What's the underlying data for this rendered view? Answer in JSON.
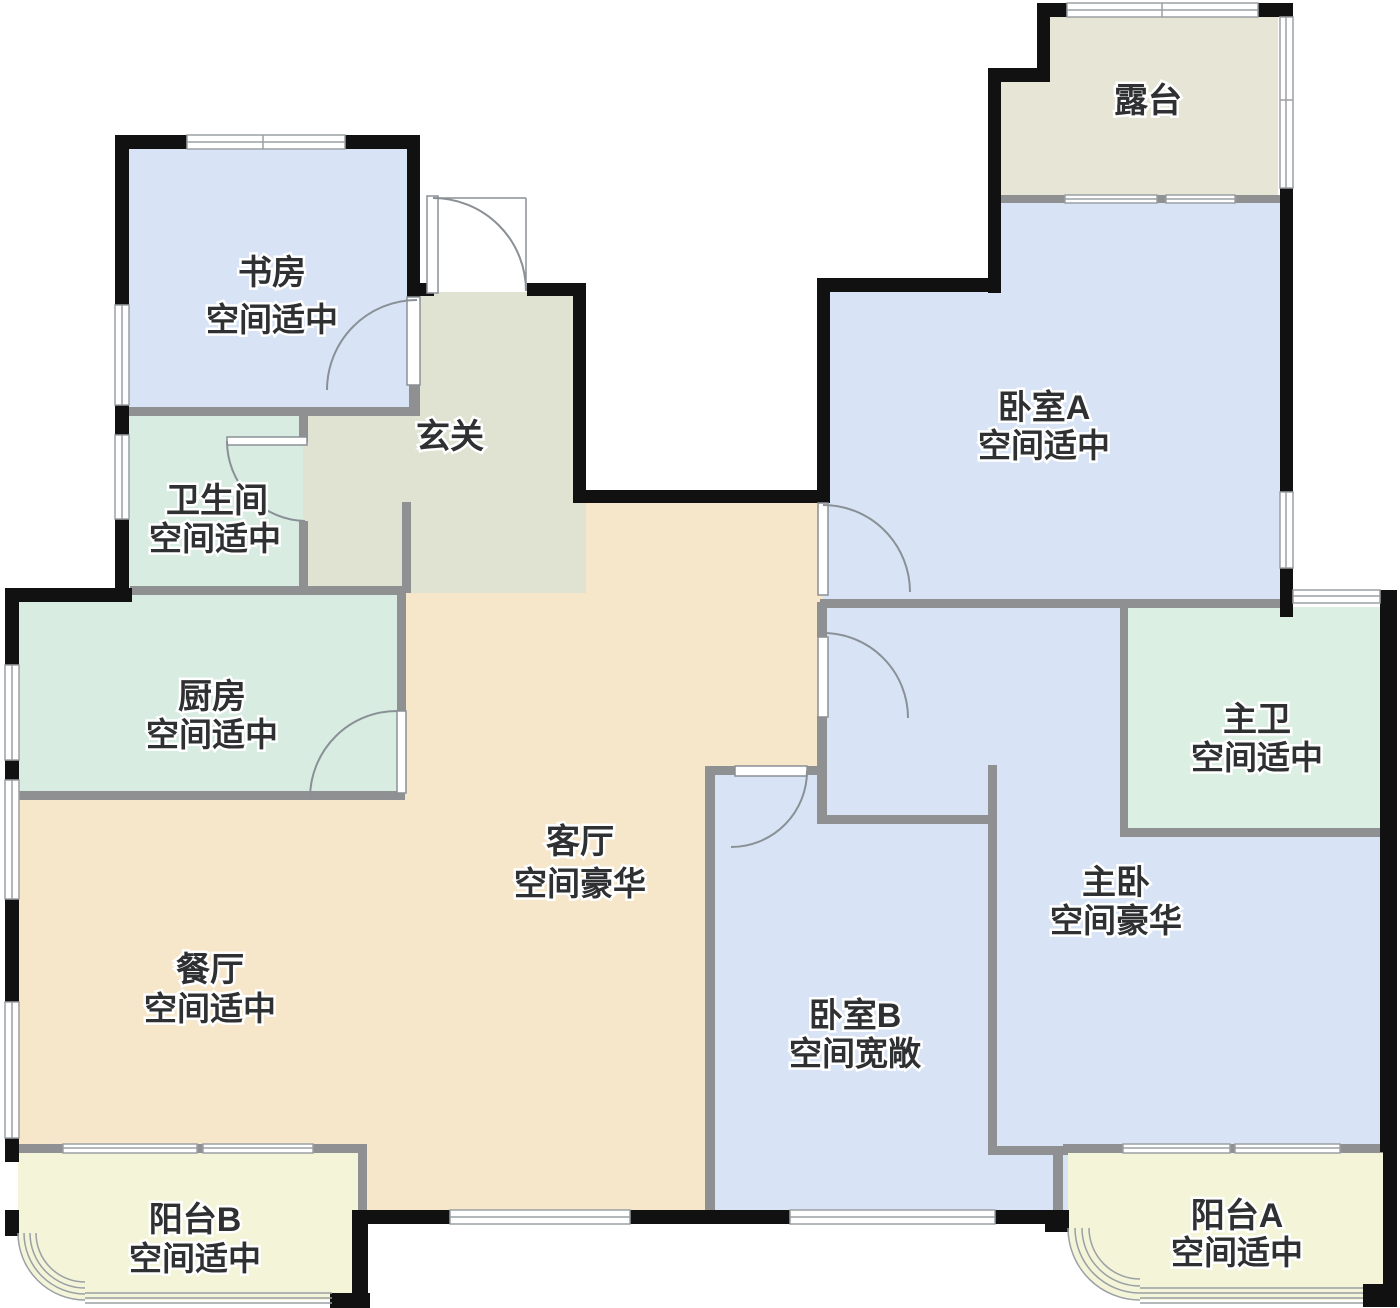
{
  "floorplan": {
    "rooms": [
      {
        "id": "study",
        "label": "书房",
        "status": "空间适中"
      },
      {
        "id": "hallway",
        "label": "玄关",
        "status": ""
      },
      {
        "id": "bathroom",
        "label": "卫生间",
        "status": "空间适中"
      },
      {
        "id": "kitchen",
        "label": "厨房",
        "status": "空间适中"
      },
      {
        "id": "living-room",
        "label": "客厅",
        "status": "空间豪华"
      },
      {
        "id": "dining-room",
        "label": "餐厅",
        "status": "空间适中"
      },
      {
        "id": "balcony-b",
        "label": "阳台B",
        "status": "空间适中"
      },
      {
        "id": "terrace",
        "label": "露台",
        "status": ""
      },
      {
        "id": "bedroom-a",
        "label": "卧室A",
        "status": "空间适中"
      },
      {
        "id": "master-bathroom",
        "label": "主卫",
        "status": "空间适中"
      },
      {
        "id": "master-bedroom",
        "label": "主卧",
        "status": "空间豪华"
      },
      {
        "id": "bedroom-b",
        "label": "卧室B",
        "status": "空间宽敞"
      },
      {
        "id": "balcony-a",
        "label": "阳台A",
        "status": "空间适中"
      }
    ],
    "colors": {
      "bedroom_blue": "#d8e4f6",
      "utility_teal": "#d8ece2",
      "master_bath_mint": "#dcefe3",
      "hallway_olive": "#e0e3d2",
      "terrace_khaki": "#e7e5d5",
      "living_beige": "#f6e7ca",
      "balcony_yellow": "#f4f4d8",
      "wall_black": "#111111",
      "wall_gray": "#8e9092",
      "door_line": "#8a9096",
      "window_line": "#9aa0a4",
      "label_text": "#2e3032"
    }
  }
}
